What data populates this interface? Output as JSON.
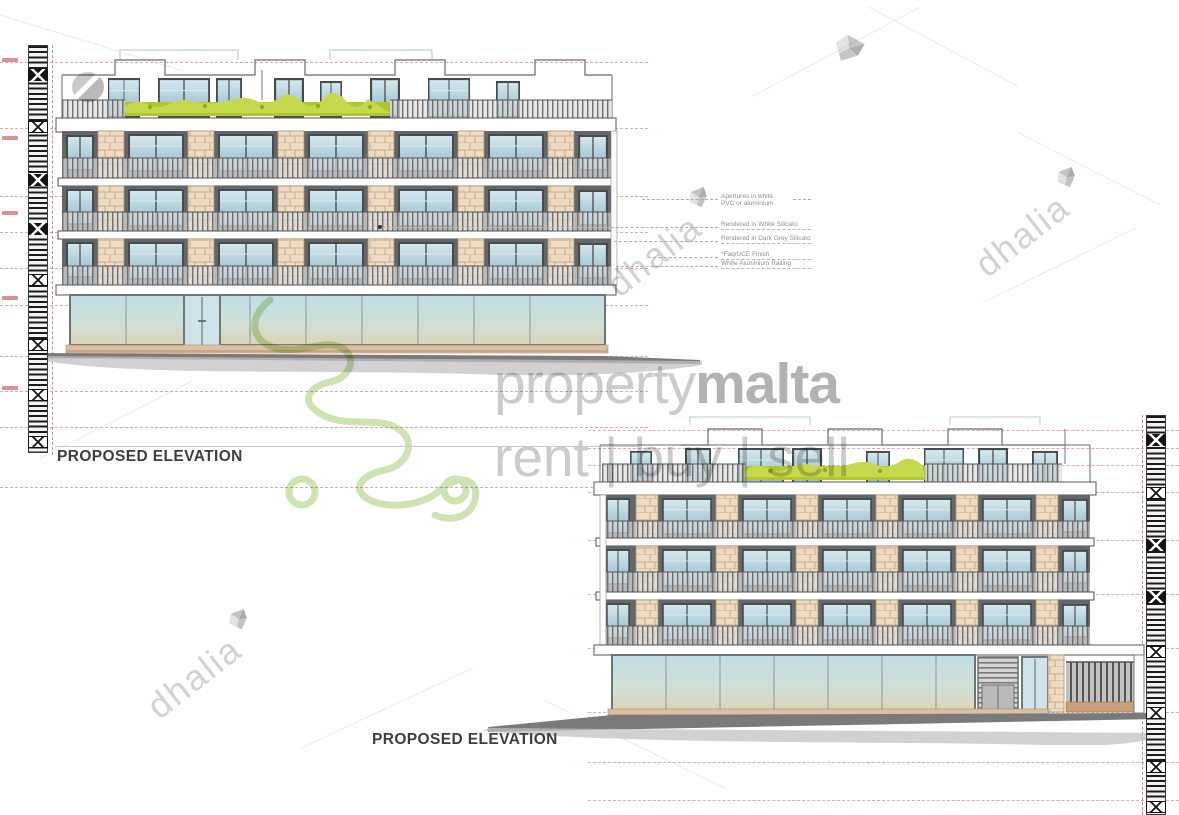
{
  "sheet": {
    "elevations": [
      {
        "label": "PROPOSED ELEVATION"
      },
      {
        "label": "PROPOSED ELEVATION"
      }
    ],
    "annotations": [
      {
        "line1": "Apertures in white",
        "line2": "PVC or aluminium"
      },
      {
        "line1": "Rendered in White Silicato"
      },
      {
        "line1": "Rendered in Dark Grey Silicato"
      },
      {
        "line1": "*Faq/UCE Finish"
      },
      {
        "line1": "White Aluminium Railing"
      }
    ]
  },
  "watermarks": {
    "brand_light": "property",
    "brand_bold": "malta",
    "tagline": "rent | buy | sell",
    "agency": "dhalia"
  },
  "colors": {
    "limestone": "#eddcc1",
    "dark_render": "#64676a",
    "white_render": "#ffffff",
    "glass_top": "#d6e9ef",
    "glass_bottom": "#8cb7c8",
    "hedge_green": "#c6d84b",
    "level_line_red": "#d67070",
    "watermark_gray": "#cbcbcb",
    "malta_outline_green": "#9cc863",
    "street_gray": "#7a7a7a"
  }
}
